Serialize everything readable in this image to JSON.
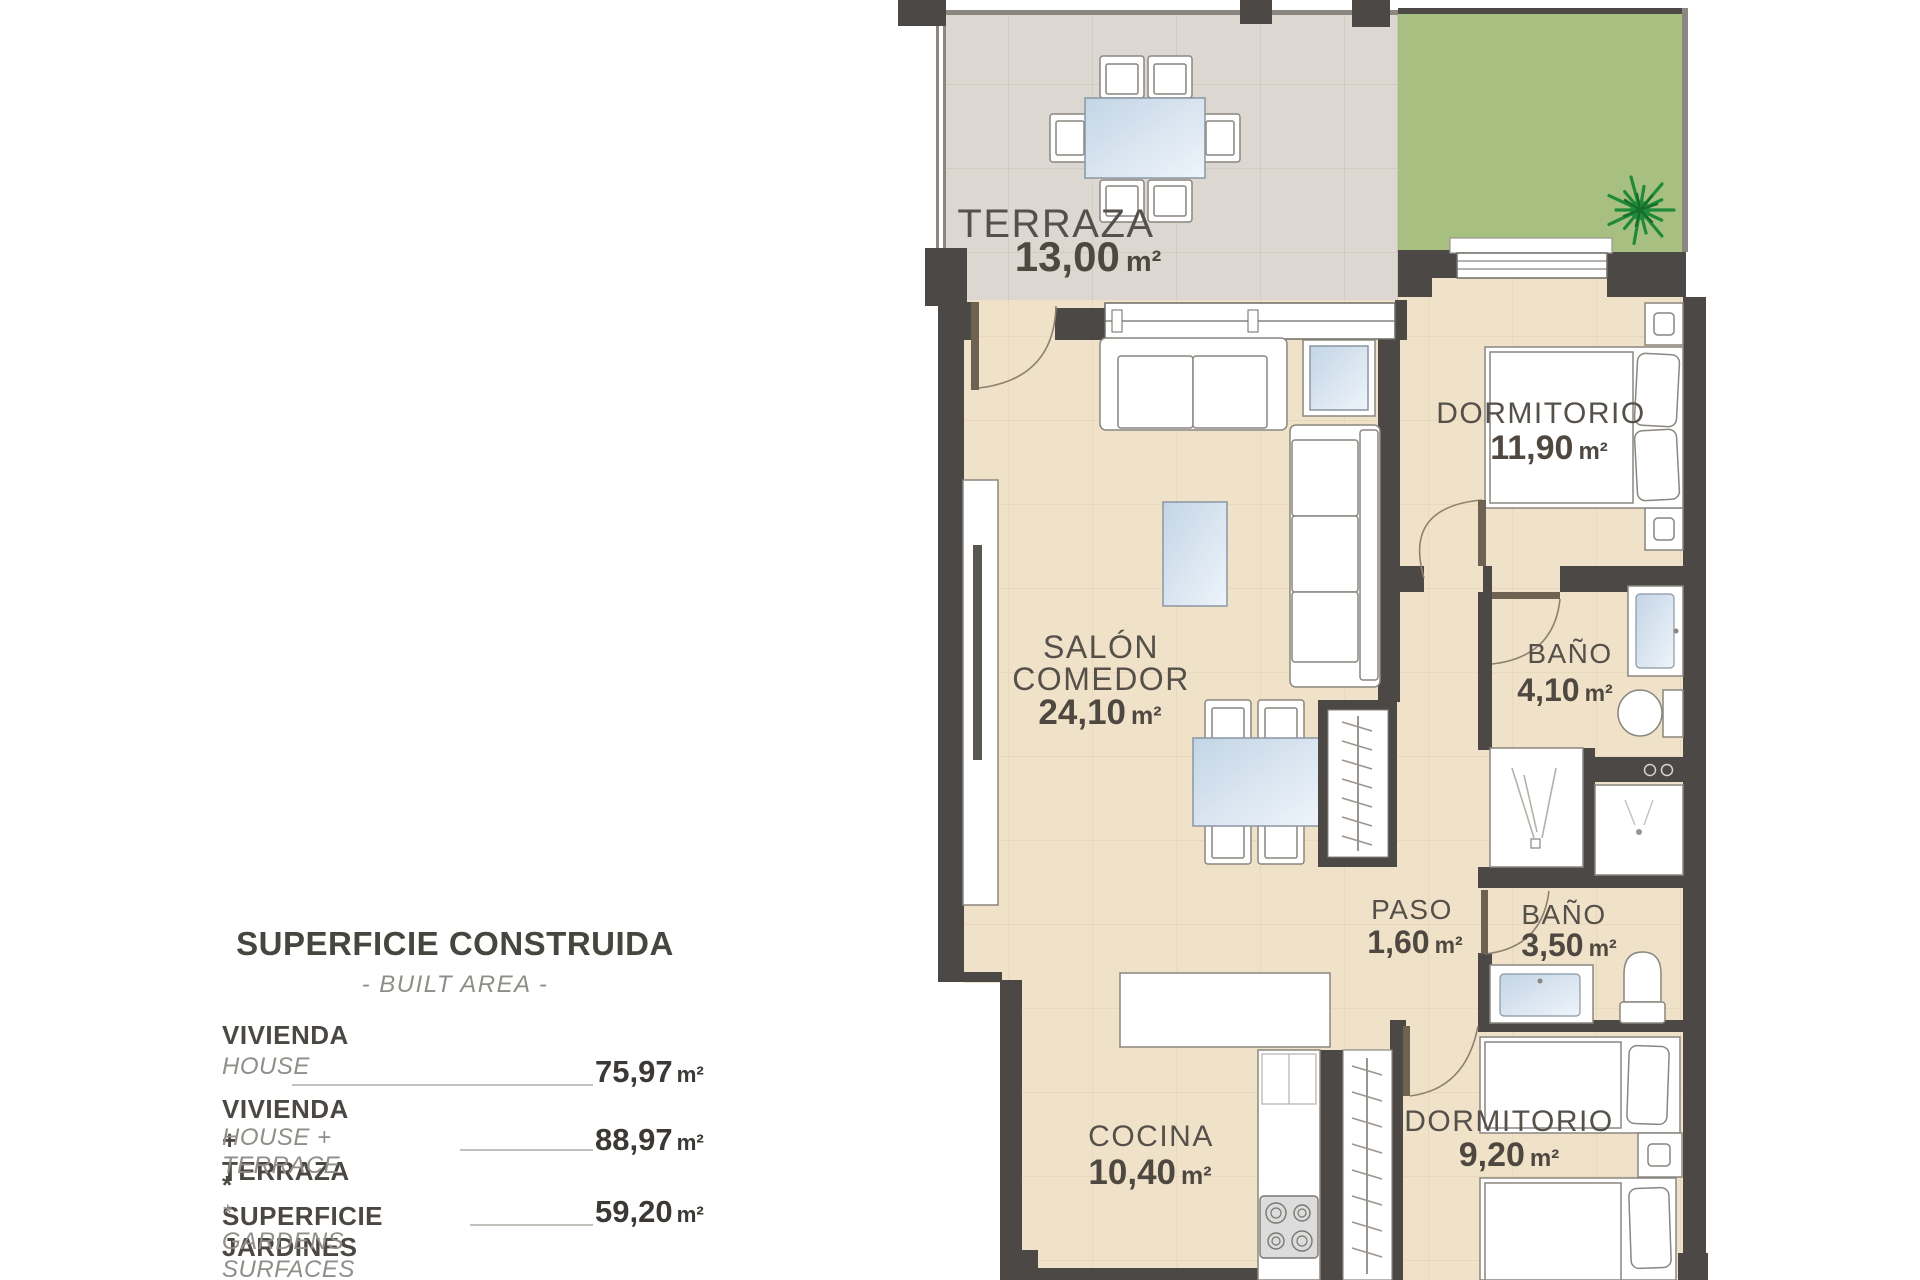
{
  "units": {
    "area": "m²"
  },
  "legend": {
    "title": "SUPERFICIE CONSTRUIDA",
    "subtitle": "- BUILT AREA -",
    "items": [
      {
        "label_es": "VIVIENDA",
        "label_en": "HOUSE",
        "value": "75,97"
      },
      {
        "label_es": "VIVIENDA + TERRAZA",
        "label_en": "HOUSE + TERRACE",
        "value": "88,97"
      },
      {
        "label_es": "* SUPERFICIE JARDINES",
        "label_en": "* GARDENS SURFACES",
        "value": "59,20"
      }
    ]
  },
  "rooms": {
    "terraza": {
      "name": "TERRAZA",
      "area": "13,00"
    },
    "salon": {
      "name_line1": "SALÓN",
      "name_line2": "COMEDOR",
      "area": "24,10"
    },
    "dormitorio1": {
      "name": "DORMITORIO",
      "area": "11,90"
    },
    "bano1": {
      "name": "BAÑO",
      "area": "4,10"
    },
    "paso": {
      "name": "PASO",
      "area": "1,60"
    },
    "bano2": {
      "name": "BAÑO",
      "area": "3,50"
    },
    "dormitorio2": {
      "name": "DORMITORIO",
      "area": "9,20"
    },
    "cocina": {
      "name": "COCINA",
      "area": "10,40"
    }
  },
  "colors": {
    "wall": "#4c4845",
    "floor": "#efe2c9",
    "terrace_floor": "#dcd8d1",
    "garden": "#a8bf82",
    "glass": "#c3d5e6",
    "label": "#55504a"
  }
}
